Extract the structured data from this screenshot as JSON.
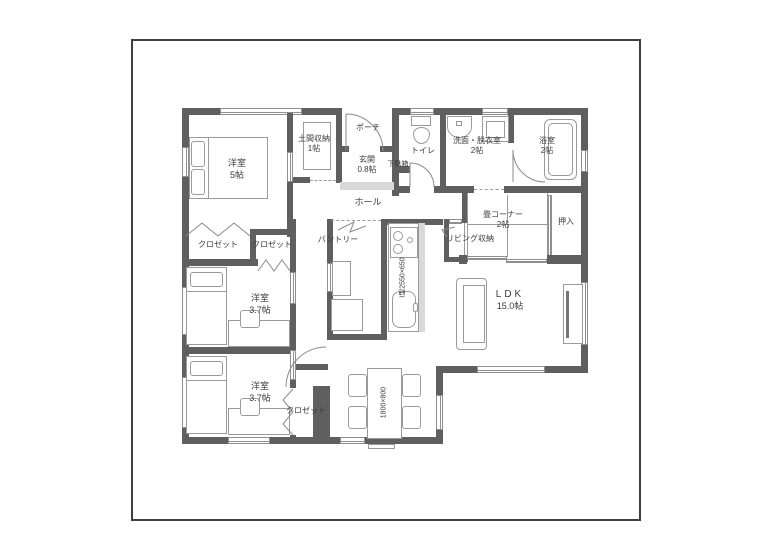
{
  "colors": {
    "wall": "#5f5f5f",
    "outline": "#9a9a9a",
    "window": "#8f8f8f",
    "text": "#3b3b3b",
    "step_fill": "#d9d9d9"
  },
  "rooms": {
    "bedroom_main": {
      "name": "洋室",
      "size": "5帖"
    },
    "doma_storage": {
      "name": "土間収納",
      "size": "1帖"
    },
    "porch": {
      "name": "ポーチ"
    },
    "entrance": {
      "name": "玄関",
      "size": "0.8帖"
    },
    "shoe_cabinet": {
      "name": "下駄箱"
    },
    "hall": {
      "name": "ホール"
    },
    "toilet": {
      "name": "トイレ"
    },
    "washroom": {
      "name": "洗面・脱衣室",
      "size": "2帖"
    },
    "bathroom": {
      "name": "浴室",
      "size": "2帖"
    },
    "tatami_corner": {
      "name": "畳コーナー",
      "size": "2帖"
    },
    "oshiire": {
      "name": "押入"
    },
    "living_storage": {
      "name": "リビング収納"
    },
    "pantry": {
      "name": "パントリー"
    },
    "closet_main": {
      "name": "クロゼット"
    },
    "closet_mid": {
      "name": "クロゼット"
    },
    "bedroom_mid": {
      "name": "洋室",
      "size": "3.7帖"
    },
    "bedroom_south": {
      "name": "洋室",
      "size": "3.7帖"
    },
    "closet_south": {
      "name": "クロゼット"
    },
    "ldk": {
      "name": "LDK",
      "size": "15.0帖"
    }
  },
  "fixtures": {
    "kitchen_label": "I型2550×650",
    "dining_table_label": "1800×800"
  }
}
